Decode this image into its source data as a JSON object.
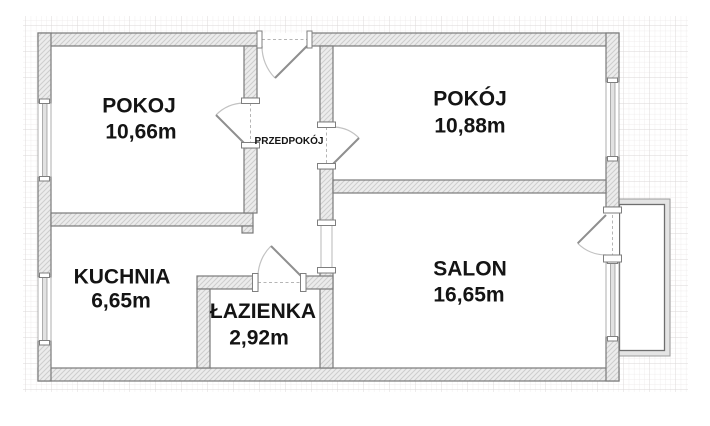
{
  "plan": {
    "type": "apartment-floor-plan",
    "rooms": [
      {
        "id": "pokoj-left",
        "name": "POKOJ",
        "area": "10,66m"
      },
      {
        "id": "pokoj-right",
        "name": "POKÓJ",
        "area": "10,88m"
      },
      {
        "id": "przedpokoj",
        "name": "PRZEDPOKÓJ",
        "area": ""
      },
      {
        "id": "kuchnia",
        "name": "KUCHNIA",
        "area": "6,65m"
      },
      {
        "id": "lazienka",
        "name": "ŁAZIENKA",
        "area": "2,92m"
      },
      {
        "id": "salon",
        "name": "SALON",
        "area": "16,65m"
      }
    ],
    "features": [
      "balcony",
      "entrance-door",
      "4-interior-doors",
      "6-windows"
    ],
    "colors": {
      "background": "#ffffff",
      "wall_fill": "#ececec",
      "wall_outline": "#7a7a7a",
      "grid_minor": "#ebe8e8",
      "grid_major": "#dbd7d7",
      "label_text": "#141414",
      "door_swing": "#c2c2c2"
    }
  }
}
